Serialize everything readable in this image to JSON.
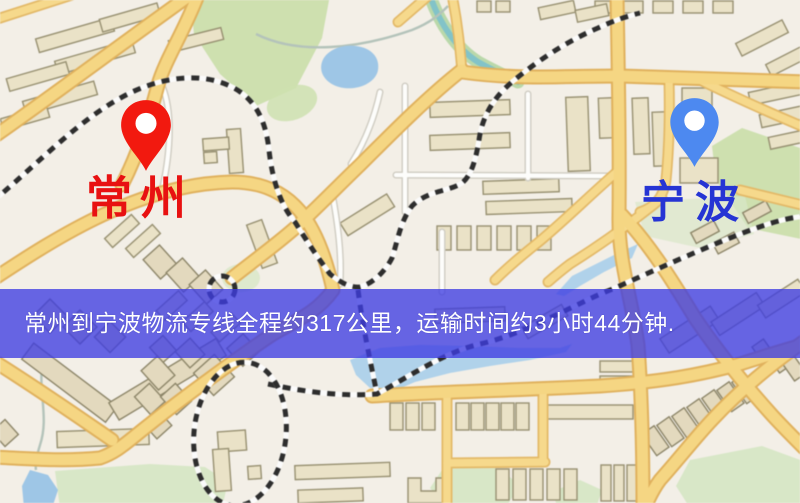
{
  "map": {
    "origin_marker": {
      "name": "常州",
      "pin_color": "#f2190f",
      "label_color": "#e81111"
    },
    "destination_marker": {
      "name": "宁波",
      "pin_color": "#4d89f0",
      "label_color": "#2634d4"
    },
    "banner": {
      "text": "常州到宁波物流专线全程约317公里，运输时间约3小时44分钟.",
      "background_color": "#3e3ce1",
      "text_color": "#ffffff"
    }
  }
}
